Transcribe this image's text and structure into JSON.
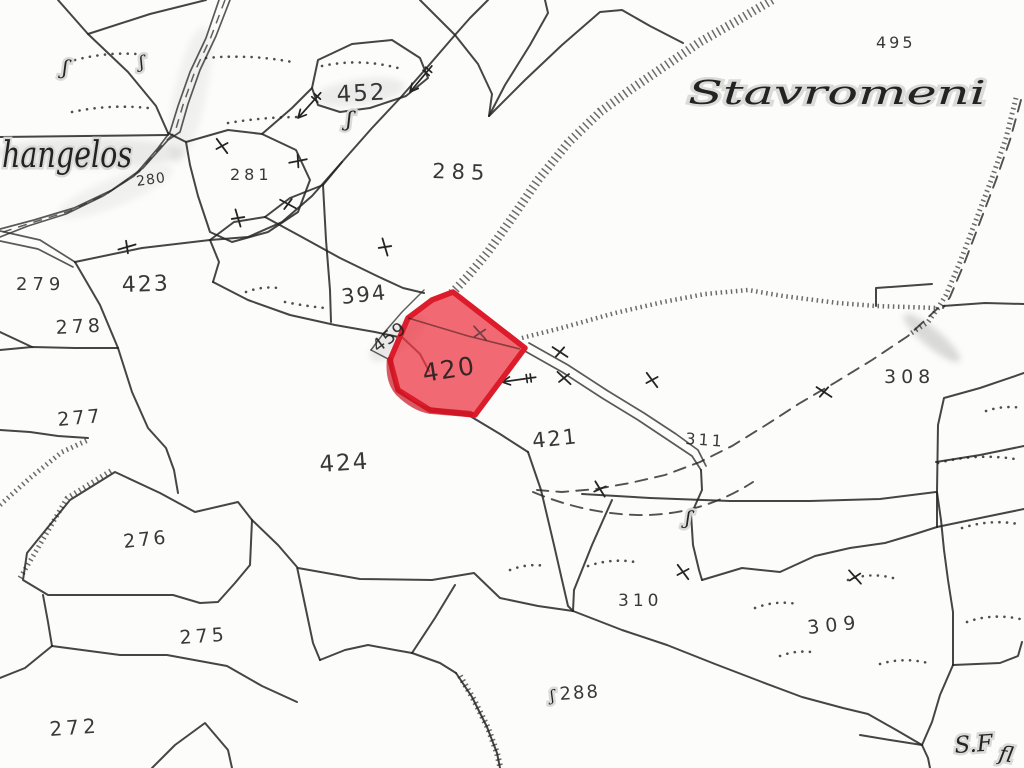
{
  "map": {
    "title": "cadastral-plan-sheet",
    "background": "#fcfcfb",
    "ink_color": "#242424",
    "highlight": {
      "label": "420",
      "fill": "#ee3a45",
      "fill_opacity": 0.75,
      "stroke": "#dc1b2b",
      "label_color": "#7d1c25",
      "label_x": 424,
      "label_y": 382,
      "label_size": 25,
      "label_rot": -9
    },
    "place_names": [
      {
        "text": "hangelos",
        "x": 2,
        "y": 167,
        "size": 36,
        "rot": 0,
        "stretch": 130
      },
      {
        "text": "Stavromeni",
        "x": 688,
        "y": 104,
        "size": 33,
        "rot": 0,
        "stretch": 298
      },
      {
        "text": "S.F",
        "x": 955,
        "y": 753,
        "size": 23,
        "rot": -4,
        "stretch": 0
      },
      {
        "text": "ﬂ",
        "x": 998,
        "y": 760,
        "size": 21,
        "rot": 10,
        "stretch": 0
      }
    ],
    "parcel_labels": [
      {
        "text": "495",
        "x": 876,
        "y": 48,
        "size": 16,
        "rot": 0,
        "spacing": 3
      },
      {
        "text": "452",
        "x": 337,
        "y": 102,
        "size": 23,
        "rot": -3,
        "spacing": 2
      },
      {
        "text": "285",
        "x": 432,
        "y": 178,
        "size": 21,
        "rot": 2,
        "spacing": 6
      },
      {
        "text": "280",
        "x": 137,
        "y": 186,
        "size": 14,
        "rot": -8,
        "spacing": 1
      },
      {
        "text": "281",
        "x": 230,
        "y": 180,
        "size": 16,
        "rot": 0,
        "spacing": 4
      },
      {
        "text": "279",
        "x": 16,
        "y": 290,
        "size": 18,
        "rot": 0,
        "spacing": 5
      },
      {
        "text": "423",
        "x": 122,
        "y": 292,
        "size": 22,
        "rot": -2,
        "spacing": 2
      },
      {
        "text": "278",
        "x": 56,
        "y": 334,
        "size": 19,
        "rot": -3,
        "spacing": 4
      },
      {
        "text": "394",
        "x": 342,
        "y": 304,
        "size": 21,
        "rot": -6,
        "spacing": 2
      },
      {
        "text": "459",
        "x": 378,
        "y": 353,
        "size": 18,
        "rot": -37,
        "spacing": 1
      },
      {
        "text": "421",
        "x": 533,
        "y": 448,
        "size": 21,
        "rot": -6,
        "spacing": 2
      },
      {
        "text": "311",
        "x": 685,
        "y": 444,
        "size": 16,
        "rot": 4,
        "spacing": 3
      },
      {
        "text": "308",
        "x": 884,
        "y": 383,
        "size": 19,
        "rot": 0,
        "spacing": 5
      },
      {
        "text": "277",
        "x": 58,
        "y": 426,
        "size": 19,
        "rot": -5,
        "spacing": 3
      },
      {
        "text": "424",
        "x": 320,
        "y": 472,
        "size": 23,
        "rot": -4,
        "spacing": 2
      },
      {
        "text": "276",
        "x": 124,
        "y": 548,
        "size": 19,
        "rot": -6,
        "spacing": 3
      },
      {
        "text": "275",
        "x": 180,
        "y": 644,
        "size": 19,
        "rot": -4,
        "spacing": 4
      },
      {
        "text": "272",
        "x": 50,
        "y": 736,
        "size": 20,
        "rot": -4,
        "spacing": 4
      },
      {
        "text": "310",
        "x": 618,
        "y": 606,
        "size": 17,
        "rot": 0,
        "spacing": 4
      },
      {
        "text": "309",
        "x": 808,
        "y": 634,
        "size": 19,
        "rot": -6,
        "spacing": 6
      },
      {
        "text": "288",
        "x": 560,
        "y": 700,
        "size": 18,
        "rot": -4,
        "spacing": 2
      }
    ],
    "symbol_marks": [
      {
        "glyph": "ʃ",
        "x": 62,
        "y": 74,
        "size": 20,
        "rot": 5
      },
      {
        "glyph": "ʃ",
        "x": 140,
        "y": 68,
        "size": 17,
        "rot": -8
      },
      {
        "glyph": "ʃ",
        "x": 346,
        "y": 126,
        "size": 21,
        "rot": 4
      },
      {
        "glyph": "ʃ",
        "x": 685,
        "y": 524,
        "size": 19,
        "rot": 6
      },
      {
        "glyph": "ʃ",
        "x": 551,
        "y": 701,
        "size": 15,
        "rot": -10
      }
    ]
  }
}
